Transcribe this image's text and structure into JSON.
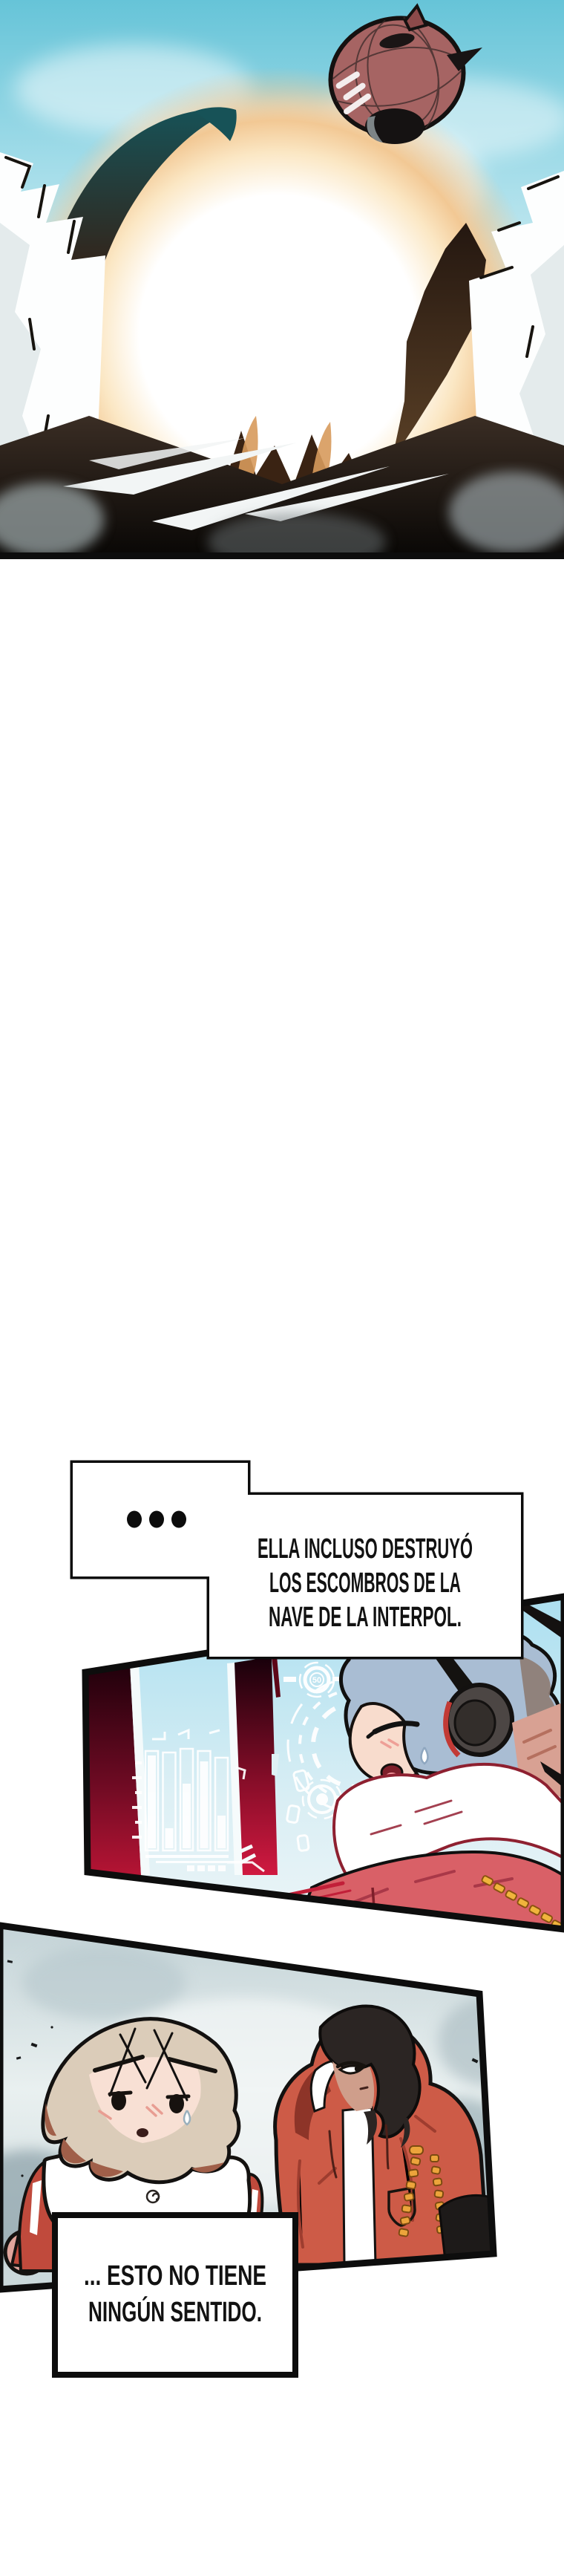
{
  "page": {
    "kind": "webtoon-comic-page",
    "background_color": "#ffffff"
  },
  "panel1": {
    "description": "sky-vortex-with-airship",
    "sky_color": "#6fc8da",
    "glow_color": "#f2c894",
    "vortex_dark_color": "#2f2015",
    "cloud_color": "#ffffff",
    "airship_body_color": "#a66463"
  },
  "bubble1": {
    "ellipsis": "...",
    "lines": [
      "ELLA INCLUSO DESTRUYÓ",
      "LOS ESCOMBROS DE LA",
      "NAVE DE LA INTERPOL."
    ]
  },
  "panel2": {
    "description": "cockpit-character-with-headphones",
    "hud_gauge_value": "50",
    "sky_color": "#b3e0ee",
    "pillar_color": "#b51434",
    "hair_color": "#a9bdd3",
    "jacket_color": "#d96067",
    "chain_color": "#f0b43c"
  },
  "panel3": {
    "description": "two-characters-in-fog",
    "fog_color": "#c7d5d8",
    "left_hair_color": "#dbccb9",
    "right_hair_color": "#2b2523",
    "left_jacket_color": "#c04a3c",
    "right_jacket_color": "#cd5b47",
    "chain_color": "#eca43b"
  },
  "bubble2": {
    "lines": [
      "... ESTO NO TIENE",
      "NINGÚN SENTIDO."
    ]
  }
}
